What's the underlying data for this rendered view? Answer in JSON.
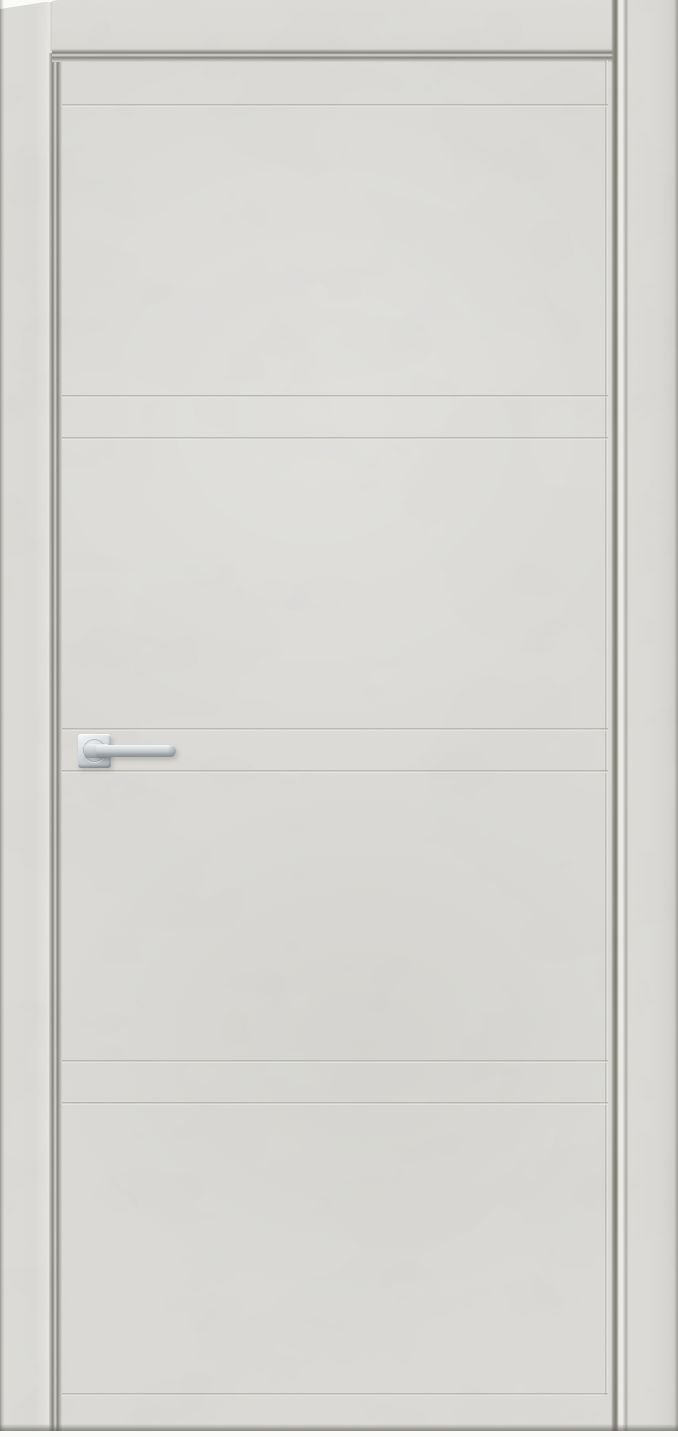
{
  "meta": {
    "type": "product-photo",
    "subject": "Closed interior door with frame, light grey concrete-look finish, horizontal groove decor, polished chrome lever handle on square rosette",
    "text_content": "none"
  },
  "colors": {
    "surface": "#d6d5d1",
    "surface_light": "#deddd9",
    "surface_dark": "#c7c6c1",
    "seam_dark": "#7b7a72",
    "groove_dark": "#9f9c94",
    "groove_light": "#e8e7e3",
    "edge_highlight": "#eceae6",
    "photo_background": "#fbfbfa",
    "chrome_light": "#f4f6f7",
    "chrome_mid": "#c6cbce",
    "chrome_dark": "#878d91",
    "floor_shadow": "#6e6d66"
  },
  "frame": {
    "left_jamb": {
      "x": 0,
      "width": 52
    },
    "right_jamb": {
      "x": 624,
      "width": 54
    },
    "header": {
      "y": 0,
      "height": 53
    }
  },
  "door": {
    "leaf": {
      "x": 56,
      "y": 56,
      "width": 559,
      "height": 1375
    },
    "inner_groove_inset": {
      "left": 62,
      "right": 608,
      "top": 60
    },
    "horizontal_grooves_y": [
      104,
      395,
      437,
      728,
      770,
      1060,
      1102,
      1393
    ],
    "bottom_shadow_y": 1428,
    "photo_bottom_strip_y": 1431
  },
  "handle": {
    "style": "square-rosette lever",
    "finish": "polished chrome",
    "rosette": {
      "x": 78,
      "y": 734,
      "width": 33,
      "height": 34
    },
    "lever": {
      "x": 84,
      "y": 744,
      "length": 92,
      "thickness": 13,
      "direction": "right"
    }
  }
}
